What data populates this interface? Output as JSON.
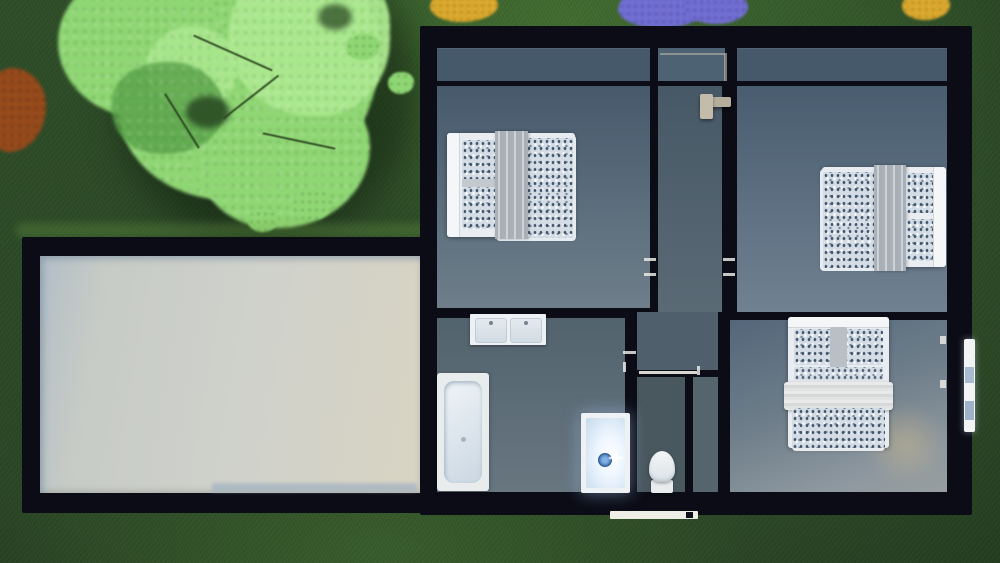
{
  "scene": {
    "type": "3d-floor-plan-render",
    "view": "top-down",
    "floor_shown": "upper floor interior with furniture",
    "surroundings": "lawn with tree canopy, shrubs and flower beds"
  },
  "colors": {
    "grass_base": "#2f4e29",
    "tree_main": "#8fd674",
    "tree_light": "#ace98f",
    "tree_dark": "#58a148",
    "bush_orange": "#94491b",
    "flower_purple": "#6f6cd0",
    "flower_yellow": "#d8a62b",
    "wall": "#0b0c16",
    "roof_garage": "#cbcec8",
    "roof_edge": "#9fb0c2",
    "floor_top": "#46596b",
    "room_dark": "#475a6c",
    "room_light": "#6e7e8a",
    "furn_white": "#e9edf1",
    "duvet_base": "#d4dde6",
    "throw_gray": "#b4bac0",
    "drain_blue": "#7fb3e8",
    "rail_beige": "#b6ae9c",
    "porch_white": "#eeeee7"
  },
  "house": {
    "rooms": [
      {
        "name": "bedroom-1",
        "position": "top-left",
        "furniture": [
          "double-bed"
        ]
      },
      {
        "name": "bedroom-2",
        "position": "top-right",
        "furniture": [
          "double-bed"
        ]
      },
      {
        "name": "bedroom-3",
        "position": "bottom-right",
        "furniture": [
          "double-bed"
        ]
      },
      {
        "name": "bathroom",
        "position": "bottom-left",
        "furniture": [
          "double-sink-vanity",
          "bathtub",
          "shower"
        ]
      },
      {
        "name": "wc",
        "position": "bottom-center",
        "furniture": [
          "toilet"
        ]
      },
      {
        "name": "hallway",
        "position": "center",
        "furniture": [
          "stair-railing"
        ]
      },
      {
        "name": "closet",
        "position": "bottom-center-right",
        "furniture": []
      }
    ],
    "exterior_features": [
      "garage-flat-roof",
      "entry-step",
      "side-window-sill"
    ]
  },
  "landscape_features": [
    "tree-canopy",
    "orange-shrub",
    "yellow-flower-bed-left",
    "purple-flower-bed",
    "yellow-flower-bed-right"
  ]
}
